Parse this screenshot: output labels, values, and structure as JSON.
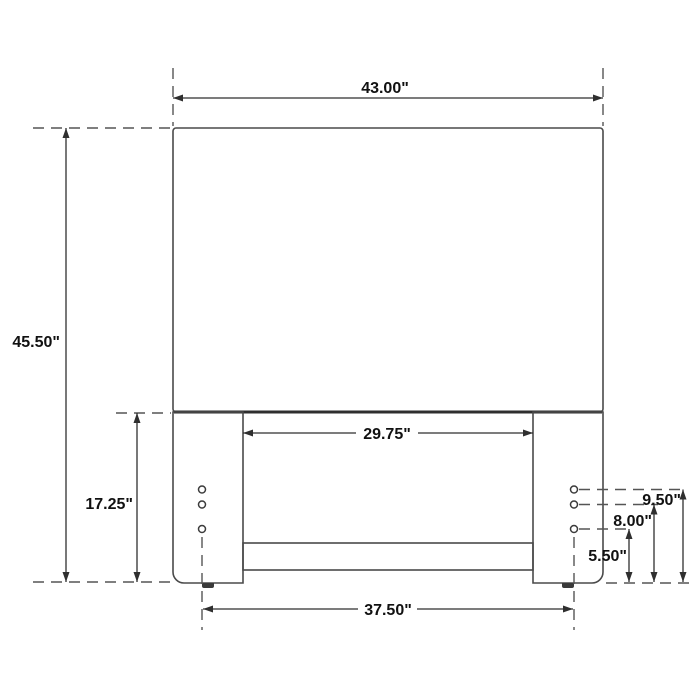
{
  "diagram": {
    "subject": "headboard-dimension-drawing",
    "labels": {
      "overall_width": "43.00\"",
      "overall_height": "45.50\"",
      "leg_height": "17.25\"",
      "between_legs_width": "29.75\"",
      "foot_span_width": "37.50\"",
      "hole_height_top": "9.50\"",
      "hole_height_middle": "8.00\"",
      "hole_height_bottom": "5.50\""
    },
    "colors": {
      "background": "#ffffff",
      "outline": "#4a4a4a",
      "dimension_line": "#2f2f2f",
      "extension_line": "#555555",
      "text": "#111111"
    }
  }
}
